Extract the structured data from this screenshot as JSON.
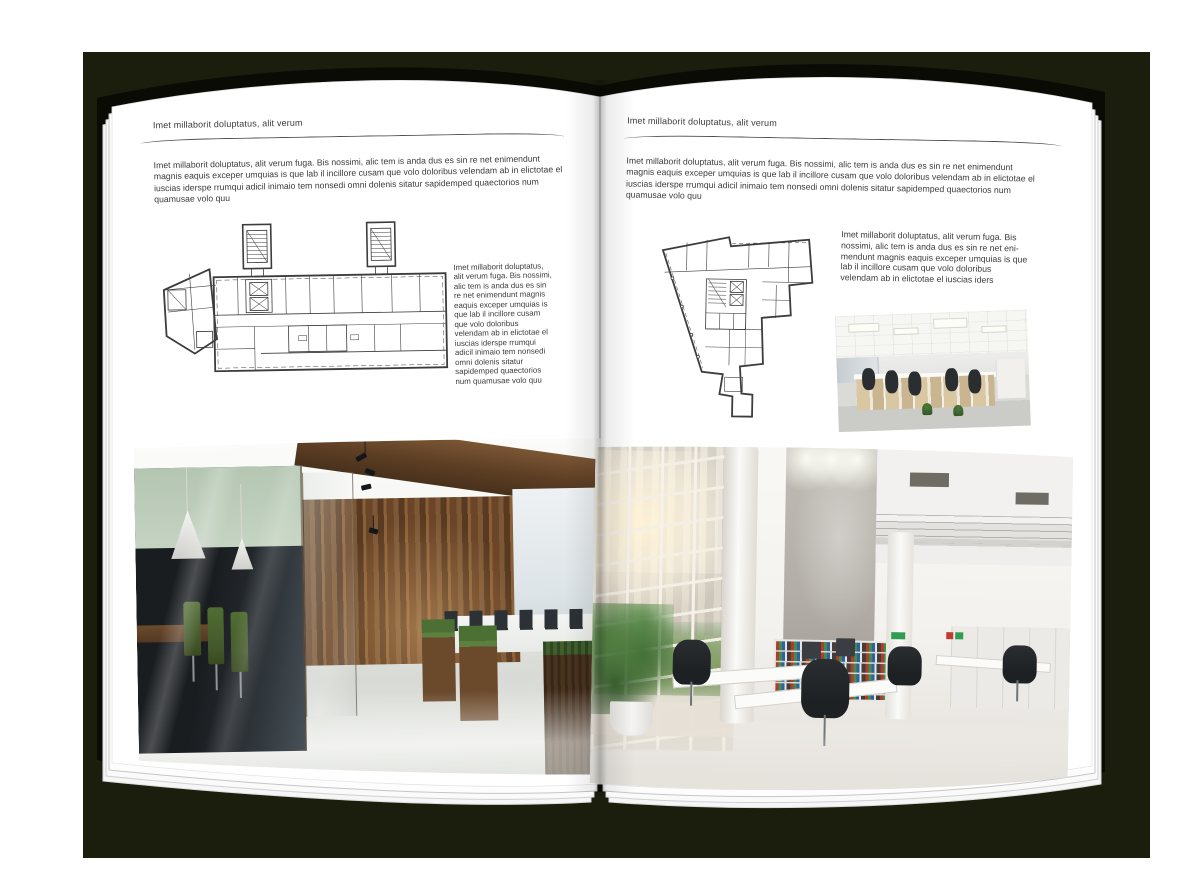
{
  "backdrop_color": "#1b1d0d",
  "book": {
    "cover_color": "#0a0b04",
    "page_color": "#ffffff"
  },
  "left_page": {
    "header": "Imet millaborit doluptatus, alit verum",
    "intro": "Imet millaborit doluptatus, alit verum fuga. Bis nossimi, alic tem is anda dus es sin re net enimendunt magnis eaquis exceper umquias is que lab il incillore cusam que volo doloribus velendam ab in elictotae el iuscias iderspe rrumqui adicil inimaio tem nonsedi omni dolenis sitatur sapidemped quaectorios num quamusae volo quu",
    "side_text": "Imet millaborit doluptatus, alit verum fuga. Bis nossimi, alic tem is anda dus es sin re net enimendunt magnis eaquis exceper umquias is que lab il incillore cusam que volo doloribus velendam ab in elictotae el iuscias iderspe rrumqui adicil inimaio tem nonsedi omni dolenis sitatur sapidemped quaectorios num quamusae volo quu",
    "figure_name": "floor-plan-wide-building",
    "photo_name": "loft-office-interior-photo"
  },
  "right_page": {
    "header": "Imet millaborit doluptatus, alit verum",
    "intro": "Imet millaborit doluptatus, alit verum fuga. Bis nossimi, alic tem is anda dus es sin re net enimendunt magnis eaquis exceper umquias is que lab il incillore cusam que volo doloribus velendam ab in elictotae el iuscias iderspe rrumqui adicil inimaio tem nonsedi omni dolenis sitatur sapidemped quaectorios num quamusae volo quu",
    "side_text": "Imet millaborit doluptatus, alit verum fuga. Bis nossimi, alic tem is anda dus es sin re net eni-mendunt magnis eaquis exceper umquias is que lab il incillore cusam que volo doloribus velendam ab in elictotae el iuscias iders",
    "figure_name": "floor-plan-irregular-building",
    "photo_small_name": "open-plan-office-photo",
    "photo_name": "bright-atrium-office-photo"
  }
}
